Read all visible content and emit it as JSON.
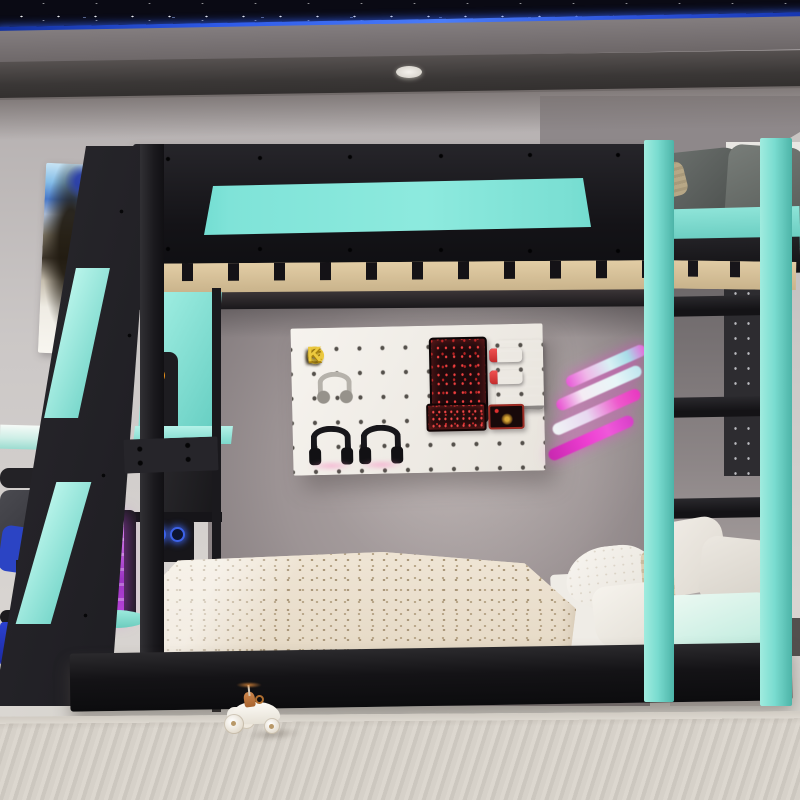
{
  "image": {
    "type": "product photograph",
    "description": "Black and teal twin-over-twin gaming bunk bed with angled front ladder, teal side ladder, built-in shelves, gaming desk corner, accessory pegboards, neon claw decal and starry LED ceiling"
  },
  "pegboard_sign": {
    "word": "ROCK",
    "letter_1": "R",
    "letter_2": "★",
    "letter_3": "C",
    "letter_4": "K"
  },
  "palette": {
    "accent_teal": "#7CE0D4",
    "frame_black": "#1A1A1E",
    "led_blue": "#2E5AE8",
    "neon_pink": "#EE3ED2",
    "neon_cyan": "#D8F0F4",
    "sign_yellow": "#ECC93E",
    "rgb_purple": "#B844D8",
    "rgb_blue_fan": "#3C62E8",
    "chair_blue": "#2B44C4",
    "wall_gray": "#9B9295",
    "wood_slats": "#DCC69E",
    "bedding_beige": "#EADFCE",
    "mattress_mint": "#C8EEE2"
  },
  "objects": [
    "starry-sky ceiling panel with blue LED strip",
    "round ceiling light",
    "anime wall poster",
    "upper bunk black guard rail with teal inset panel",
    "wooden bed slats",
    "white pegboard with ROCK sign, headphones, keyboards, handheld consoles and mouse pad",
    "neon pink and cyan claw-mark wall decal",
    "dark pegboard with game controllers",
    "teal right ladder with black rungs",
    "black angled front ladder with teal inserts",
    "built-in shelf with speaker and RGB PC",
    "gaming desk with chair and purple RGB PC tower",
    "upper bunk with gray pillows and teal mattress",
    "lower bed with beige dotted comforter and white pillows",
    "mint mattress and knit pillow",
    "striped beige rug",
    "white toy race car"
  ]
}
